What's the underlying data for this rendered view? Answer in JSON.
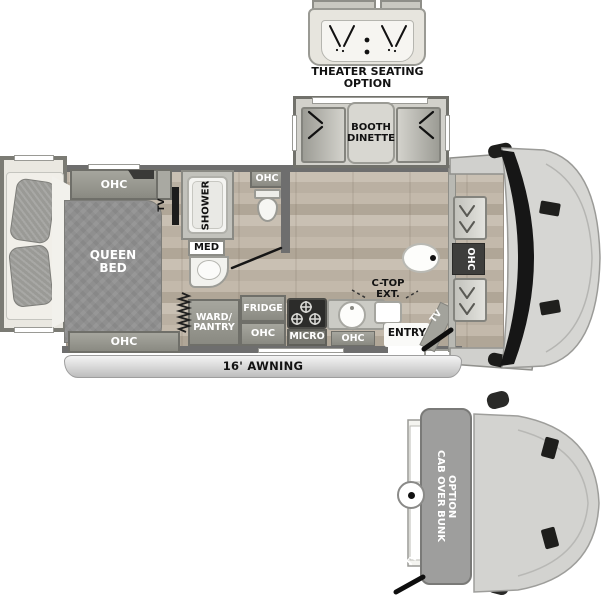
{
  "theater": {
    "line1": "THEATER SEATING",
    "line2": "OPTION"
  },
  "dinette": {
    "line1": "BOOTH",
    "line2": "DINETTE"
  },
  "bedroom": {
    "ohc_top": "OHC",
    "ohc_bottom": "OHC",
    "tv": "TV",
    "bed_line1": "QUEEN",
    "bed_line2": "BED"
  },
  "bath": {
    "shower": "SHOWER",
    "med": "MED",
    "toilet_ohc": "OHC"
  },
  "kitchen": {
    "ward1": "WARD/",
    "ward2": "PANTRY",
    "fridge": "FRIDGE",
    "fridge_ohc": "OHC",
    "micro": "MICRO",
    "sink_ohc": "OHC",
    "ctop1": "C-TOP",
    "ctop2": "EXT.",
    "entry": "ENTRY",
    "entry_tv": "TV"
  },
  "cab": {
    "ohc": "OHC"
  },
  "awning": {
    "label": "16' AWNING"
  },
  "bunk": {
    "line1": "CAB OVER BUNK",
    "line2": "OPTION",
    "tv": "TV"
  },
  "colors": {
    "wall": "#6e6e6e",
    "floor": "#c1b8ac",
    "bed": "#8f8f8f",
    "cabinet": "#95958d",
    "vehicle_body": "#d6d6d3",
    "glass": "#161616",
    "accent_dark": "#2c2c2a"
  }
}
